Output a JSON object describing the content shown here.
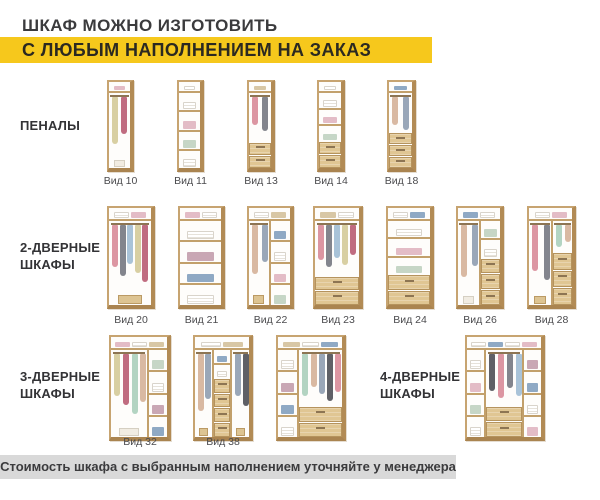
{
  "title": {
    "line1": "ШКАФ МОЖНО ИЗГОТОВИТЬ",
    "line2": "С ЛЮБЫМ НАПОЛНЕНИЕМ НА ЗАКАЗ"
  },
  "footer": {
    "text": "Стоимость шкафа с выбранным наполнением уточняйте у менеджера"
  },
  "sections": {
    "penaly": {
      "label": "ПЕНАЛЫ"
    },
    "two_door": {
      "line1": "2-ДВЕРНЫЕ",
      "line2": "ШКАФЫ"
    },
    "three_door": {
      "line1": "3-ДВЕРНЫЕ",
      "line2": "ШКАФЫ"
    },
    "four_door": {
      "line1": "4-ДВЕРНЫЕ",
      "line2": "ШКАФЫ"
    }
  },
  "colors": {
    "accent_yellow": "#f6c81c",
    "footer_gray": "#d9d9d9",
    "text_dark": "#3b3b3d",
    "wood_frame": "#c7a471",
    "wood_dark": "#b28b55",
    "wood_shelf": "#c2a06b",
    "drawer_front": "#e0c693",
    "interior_white": "#fefdfb"
  },
  "palettes": {
    "clothes": [
      "#dc96a2",
      "#83858d",
      "#a9c3d8",
      "#d8cfa2",
      "#c06c80",
      "#b3d4c2",
      "#d9b9a2",
      "#9aa7b8",
      "#5f6066"
    ],
    "shelf_items": [
      "#9db8d2",
      "#e3bcc6",
      "#c6d6c6",
      "#d8c7a5",
      "#c9a7b4",
      "#8fa9c4"
    ]
  },
  "rows": [
    {
      "id": "penaly",
      "top": 80,
      "cab_h": 92,
      "label_y": 175,
      "cabinets": [
        {
          "label": "Вид 10",
          "x": 107,
          "w": 27,
          "top": true,
          "cols": [
            {
              "f": 1,
              "z": [
                [
                  "hang",
                  4.2
                ],
                [
                  "floor",
                  0.9
                ]
              ]
            }
          ]
        },
        {
          "label": "Вид 11",
          "x": 177,
          "w": 27,
          "top": true,
          "cols": [
            {
              "f": 1,
              "z": [
                [
                  "shelves",
                  4
                ]
              ]
            }
          ]
        },
        {
          "label": "Вид 13",
          "x": 247,
          "w": 28,
          "top": true,
          "cols": [
            {
              "f": 1,
              "z": [
                [
                  "hang",
                  3.1
                ],
                [
                  "drawers",
                  2
                ]
              ]
            }
          ]
        },
        {
          "label": "Вид 14",
          "x": 317,
          "w": 28,
          "top": true,
          "cols": [
            {
              "f": 1,
              "z": [
                [
                  "shelves",
                  3
                ],
                [
                  "drawers",
                  2
                ]
              ]
            }
          ]
        },
        {
          "label": "Вид 18",
          "x": 387,
          "w": 29,
          "top": true,
          "cols": [
            {
              "f": 1,
              "z": [
                [
                  "hang",
                  2.8
                ],
                [
                  "drawers",
                  3
                ]
              ]
            }
          ]
        }
      ]
    },
    {
      "id": "two-door",
      "top": 206,
      "cab_h": 103,
      "label_y": 314,
      "cabinets": [
        {
          "label": "Вид 20",
          "x": 107,
          "w": 48,
          "top": true,
          "cols": [
            {
              "f": 1,
              "z": [
                [
                  "hang",
                  4
                ],
                [
                  "floor",
                  0.9
                ]
              ]
            }
          ]
        },
        {
          "label": "Вид 21",
          "x": 178,
          "w": 47,
          "top": true,
          "cols": [
            {
              "f": 1,
              "z": [
                [
                  "shelves",
                  4
                ]
              ]
            }
          ]
        },
        {
          "label": "Вид 22",
          "x": 247,
          "w": 47,
          "top": true,
          "cols": [
            {
              "f": 1,
              "z": [
                [
                  "hang",
                  3.6
                ],
                [
                  "floor",
                  0.9
                ]
              ]
            },
            {
              "f": 1,
              "z": [
                [
                  "shelves",
                  4
                ]
              ]
            }
          ]
        },
        {
          "label": "Вид 23",
          "x": 313,
          "w": 50,
          "top": true,
          "cols": [
            {
              "f": 1,
              "z": [
                [
                  "hang",
                  3.2
                ],
                [
                  "drawers",
                  2
                ]
              ]
            }
          ]
        },
        {
          "label": "Вид 24",
          "x": 386,
          "w": 48,
          "top": true,
          "cols": [
            {
              "f": 1,
              "z": [
                [
                  "shelves",
                  3
                ],
                [
                  "drawers",
                  2
                ]
              ]
            }
          ]
        },
        {
          "label": "Вид 26",
          "x": 456,
          "w": 48,
          "top": true,
          "cols": [
            {
              "f": 1.1,
              "z": [
                [
                  "hang",
                  3.7
                ],
                [
                  "floor",
                  0.8
                ]
              ]
            },
            {
              "f": 1,
              "z": [
                [
                  "shelves",
                  2
                ],
                [
                  "drawers",
                  3
                ]
              ]
            }
          ]
        },
        {
          "label": "Вид 28",
          "x": 527,
          "w": 49,
          "top": true,
          "cols": [
            {
              "f": 1.2,
              "z": [
                [
                  "hang",
                  3.7
                ],
                [
                  "floor",
                  0.8
                ]
              ]
            },
            {
              "f": 1,
              "z": [
                [
                  "hang",
                  1.5
                ],
                [
                  "drawers",
                  3
                ]
              ]
            }
          ]
        }
      ]
    },
    {
      "id": "three-door",
      "top": 335,
      "cab_h": 106,
      "label_y": 436,
      "cabinets": [
        {
          "label": "Вид 32",
          "x": 109,
          "w": 62,
          "top": true,
          "cols": [
            {
              "f": 2.05,
              "z": [
                [
                  "hang",
                  3.8
                ],
                [
                  "floor",
                  0.8
                ]
              ]
            },
            {
              "f": 1,
              "z": [
                [
                  "shelves",
                  4
                ]
              ]
            }
          ]
        },
        {
          "label": "Вид 38",
          "x": 193,
          "w": 60,
          "top": true,
          "cols": [
            {
              "f": 1,
              "z": [
                [
                  "hang",
                  3.8
                ],
                [
                  "floor",
                  0.8
                ]
              ]
            },
            {
              "f": 1,
              "z": [
                [
                  "shelves",
                  1.6
                ],
                [
                  "drawers",
                  4
                ]
              ]
            },
            {
              "f": 1,
              "z": [
                [
                  "hang",
                  3.8
                ],
                [
                  "floor",
                  0.8
                ]
              ]
            }
          ]
        },
        {
          "label": null,
          "x": 276,
          "w": 70,
          "top": true,
          "cols": [
            {
              "f": 1,
              "z": [
                [
                  "shelves",
                  4
                ]
              ]
            },
            {
              "f": 2.2,
              "z": [
                [
                  "hang",
                  3.1
                ],
                [
                  "drawers",
                  2
                ]
              ]
            }
          ]
        },
        {
          "label": null,
          "x": 465,
          "w": 80,
          "top": true,
          "cols": [
            {
              "f": 1,
              "z": [
                [
                  "shelves",
                  4
                ]
              ]
            },
            {
              "f": 2.1,
              "z": [
                [
                  "hang",
                  3
                ],
                [
                  "drawers",
                  2
                ]
              ]
            },
            {
              "f": 1,
              "z": [
                [
                  "shelves",
                  4
                ]
              ]
            }
          ]
        }
      ]
    }
  ]
}
